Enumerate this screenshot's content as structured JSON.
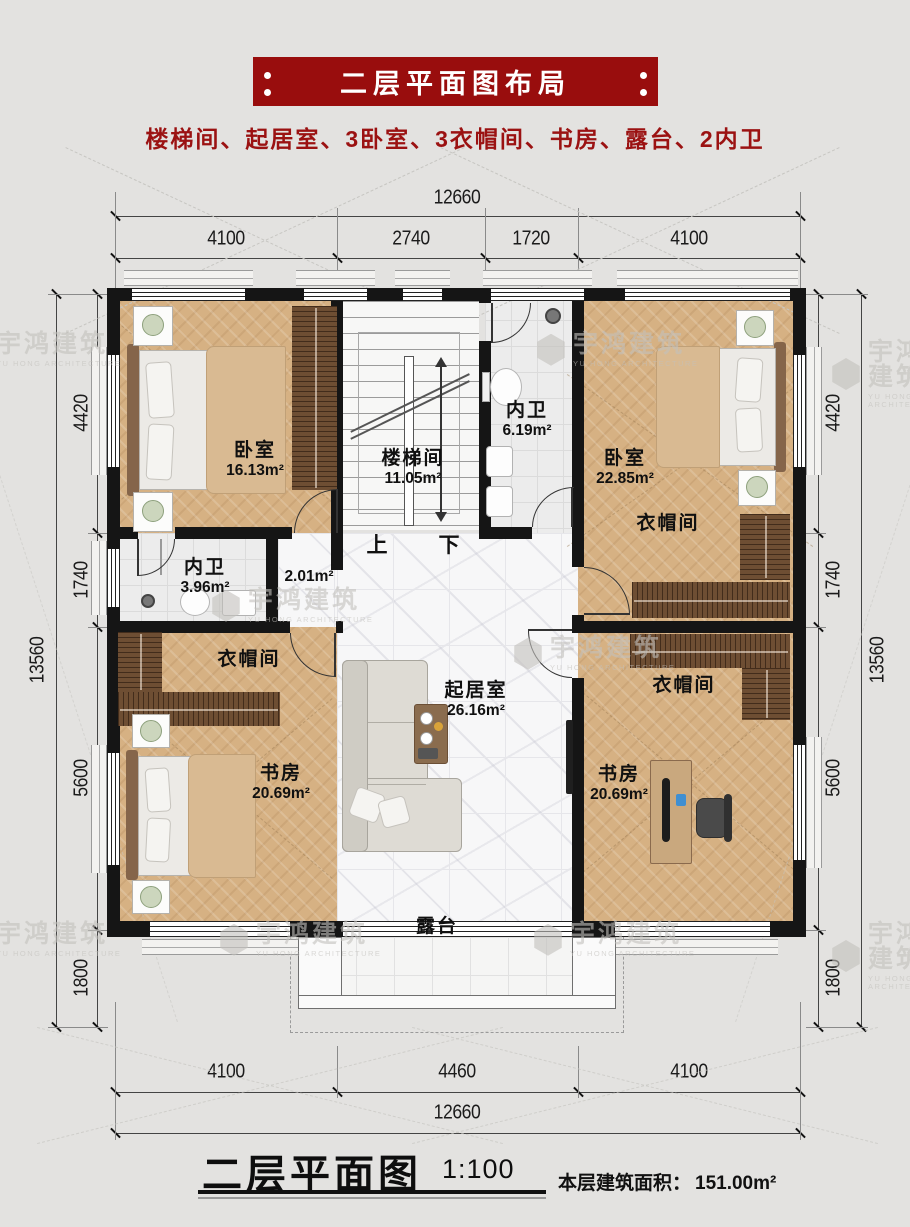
{
  "header": {
    "title": "二层平面图布局",
    "subtitle": "楼梯间、起居室、3卧室、3衣帽间、书房、露台、2内卫"
  },
  "watermark": {
    "cn": "宇鸿建筑",
    "en": "YU HONG ARCHITECTURE"
  },
  "dims": {
    "top_total": "12660",
    "top_segments": [
      "4100",
      "2740",
      "1720",
      "4100"
    ],
    "left_total": "13560",
    "left_segments": [
      "4420",
      "1740",
      "5600",
      "1800"
    ],
    "right_total": "13560",
    "right_segments": [
      "4420",
      "1740",
      "5600",
      "1800"
    ],
    "bottom_segments": [
      "4100",
      "4460",
      "4100"
    ],
    "bottom_total": "12660"
  },
  "rooms": {
    "bedroom_left": {
      "name": "卧室",
      "area": "16.13m²"
    },
    "stairwell": {
      "name": "楼梯间",
      "area": "11.05m²",
      "up": "上",
      "down": "下"
    },
    "bath_top": {
      "name": "内卫",
      "area": "6.19m²"
    },
    "bedroom_right": {
      "name": "卧室",
      "area": "22.85m²"
    },
    "closet_right_top": {
      "name": "衣帽间"
    },
    "bath_mid": {
      "name": "内卫",
      "area": "3.96m²"
    },
    "hall": {
      "area": "2.01m²"
    },
    "closet_left": {
      "name": "衣帽间"
    },
    "living": {
      "name": "起居室",
      "area": "26.16m²"
    },
    "study_left": {
      "name": "书房",
      "area": "20.69m²"
    },
    "closet_right_bottom": {
      "name": "衣帽间"
    },
    "study_right": {
      "name": "书房",
      "area": "20.69m²"
    },
    "terrace": {
      "name": "露台"
    }
  },
  "footer": {
    "title": "二层平面图",
    "scale": "1:100",
    "area_label": "本层建筑面积：",
    "area_value": "151.00m²"
  }
}
